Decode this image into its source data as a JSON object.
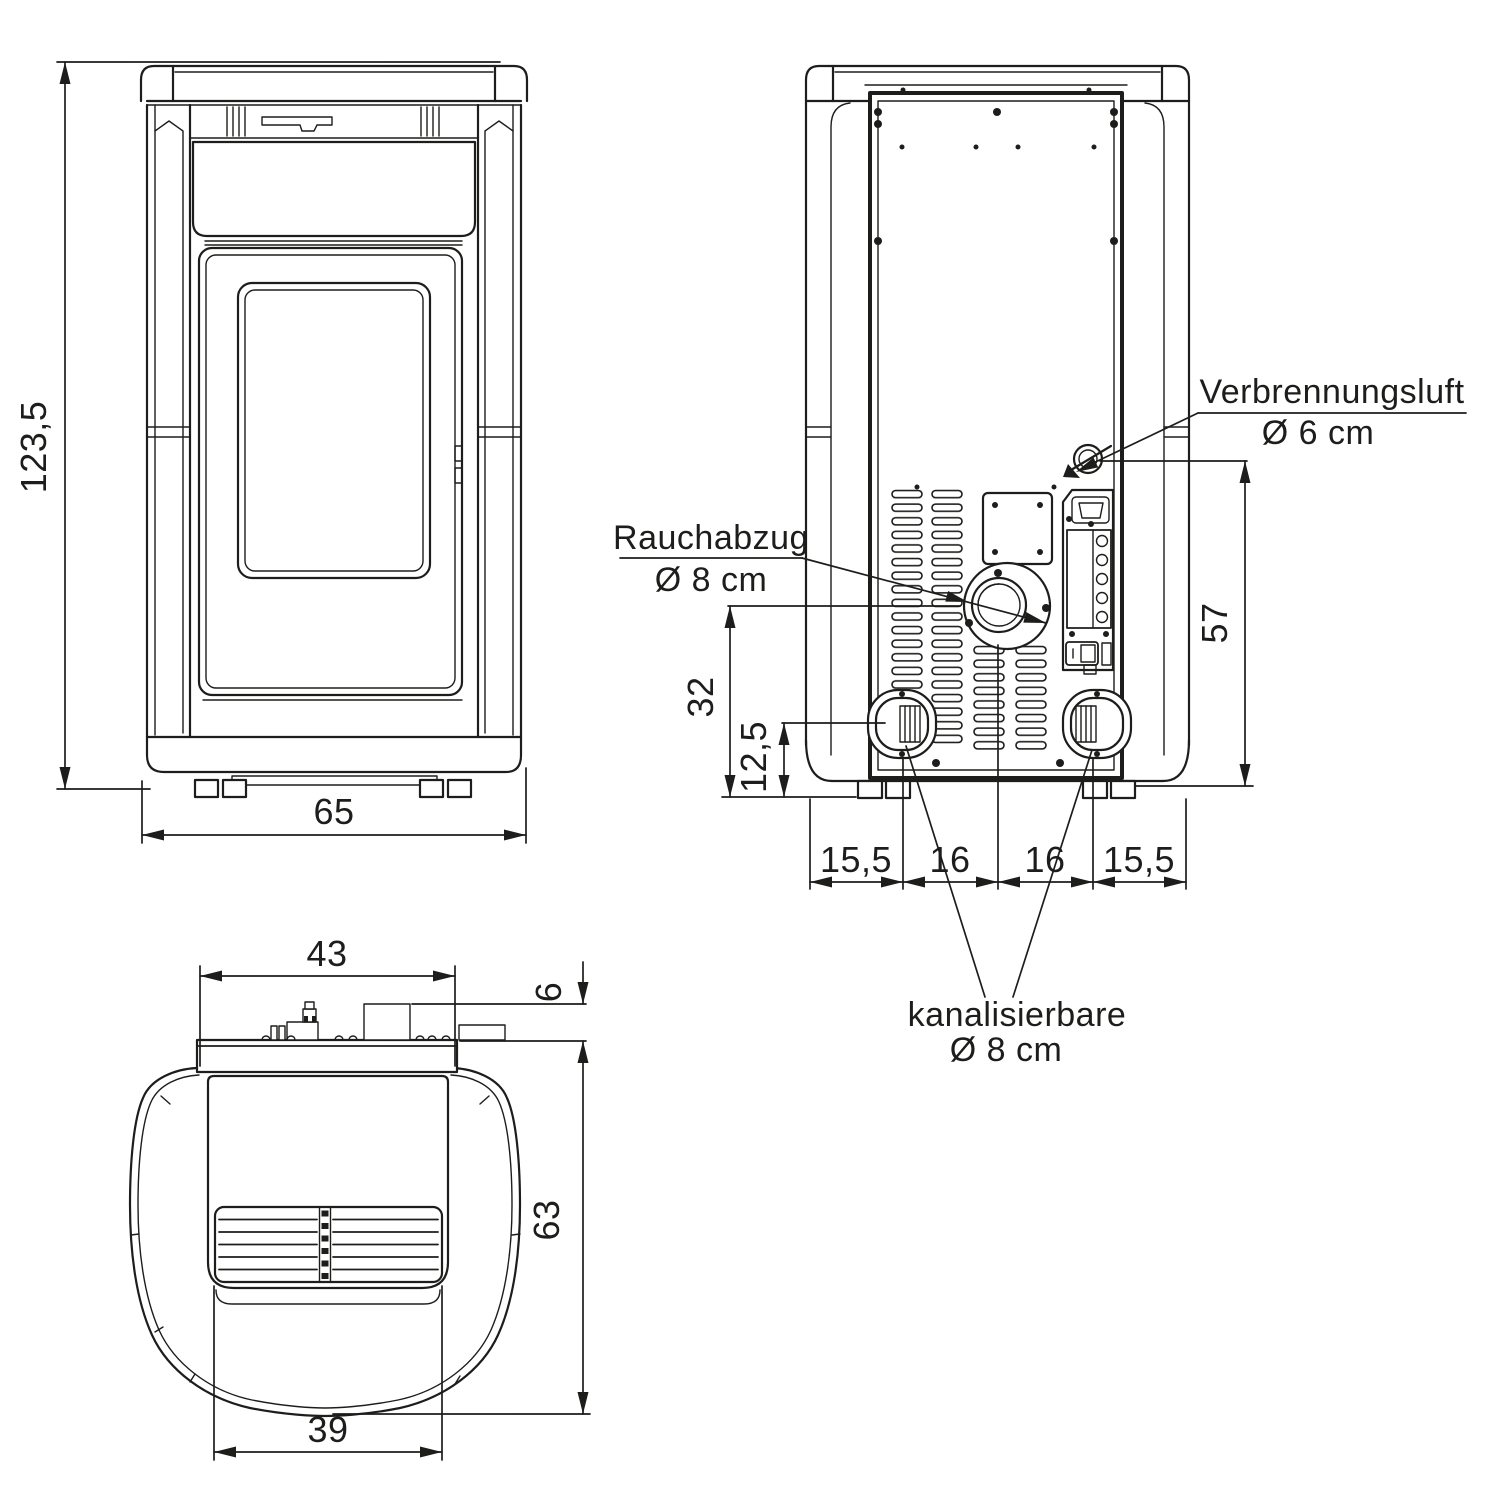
{
  "colors": {
    "background": "#ffffff",
    "line": "#1d1d1b"
  },
  "front_view": {
    "height": "123,5",
    "width": "65"
  },
  "rear_view": {
    "air_inlet_label": "Verbrennungsluft",
    "air_inlet_diameter": "Ø 6 cm",
    "flue_label": "Rauchabzug",
    "flue_diameter": "Ø 8 cm",
    "duct_label": "kanalisierbare",
    "duct_diameter": "Ø 8 cm",
    "air_inlet_height": "57",
    "flue_height": "32",
    "duct_height": "12,5",
    "bottom_spacing": [
      "15,5",
      "16",
      "16",
      "15,5"
    ]
  },
  "top_view": {
    "back_width": "43",
    "rear_offset": "6",
    "depth": "63",
    "grille_width": "39"
  }
}
